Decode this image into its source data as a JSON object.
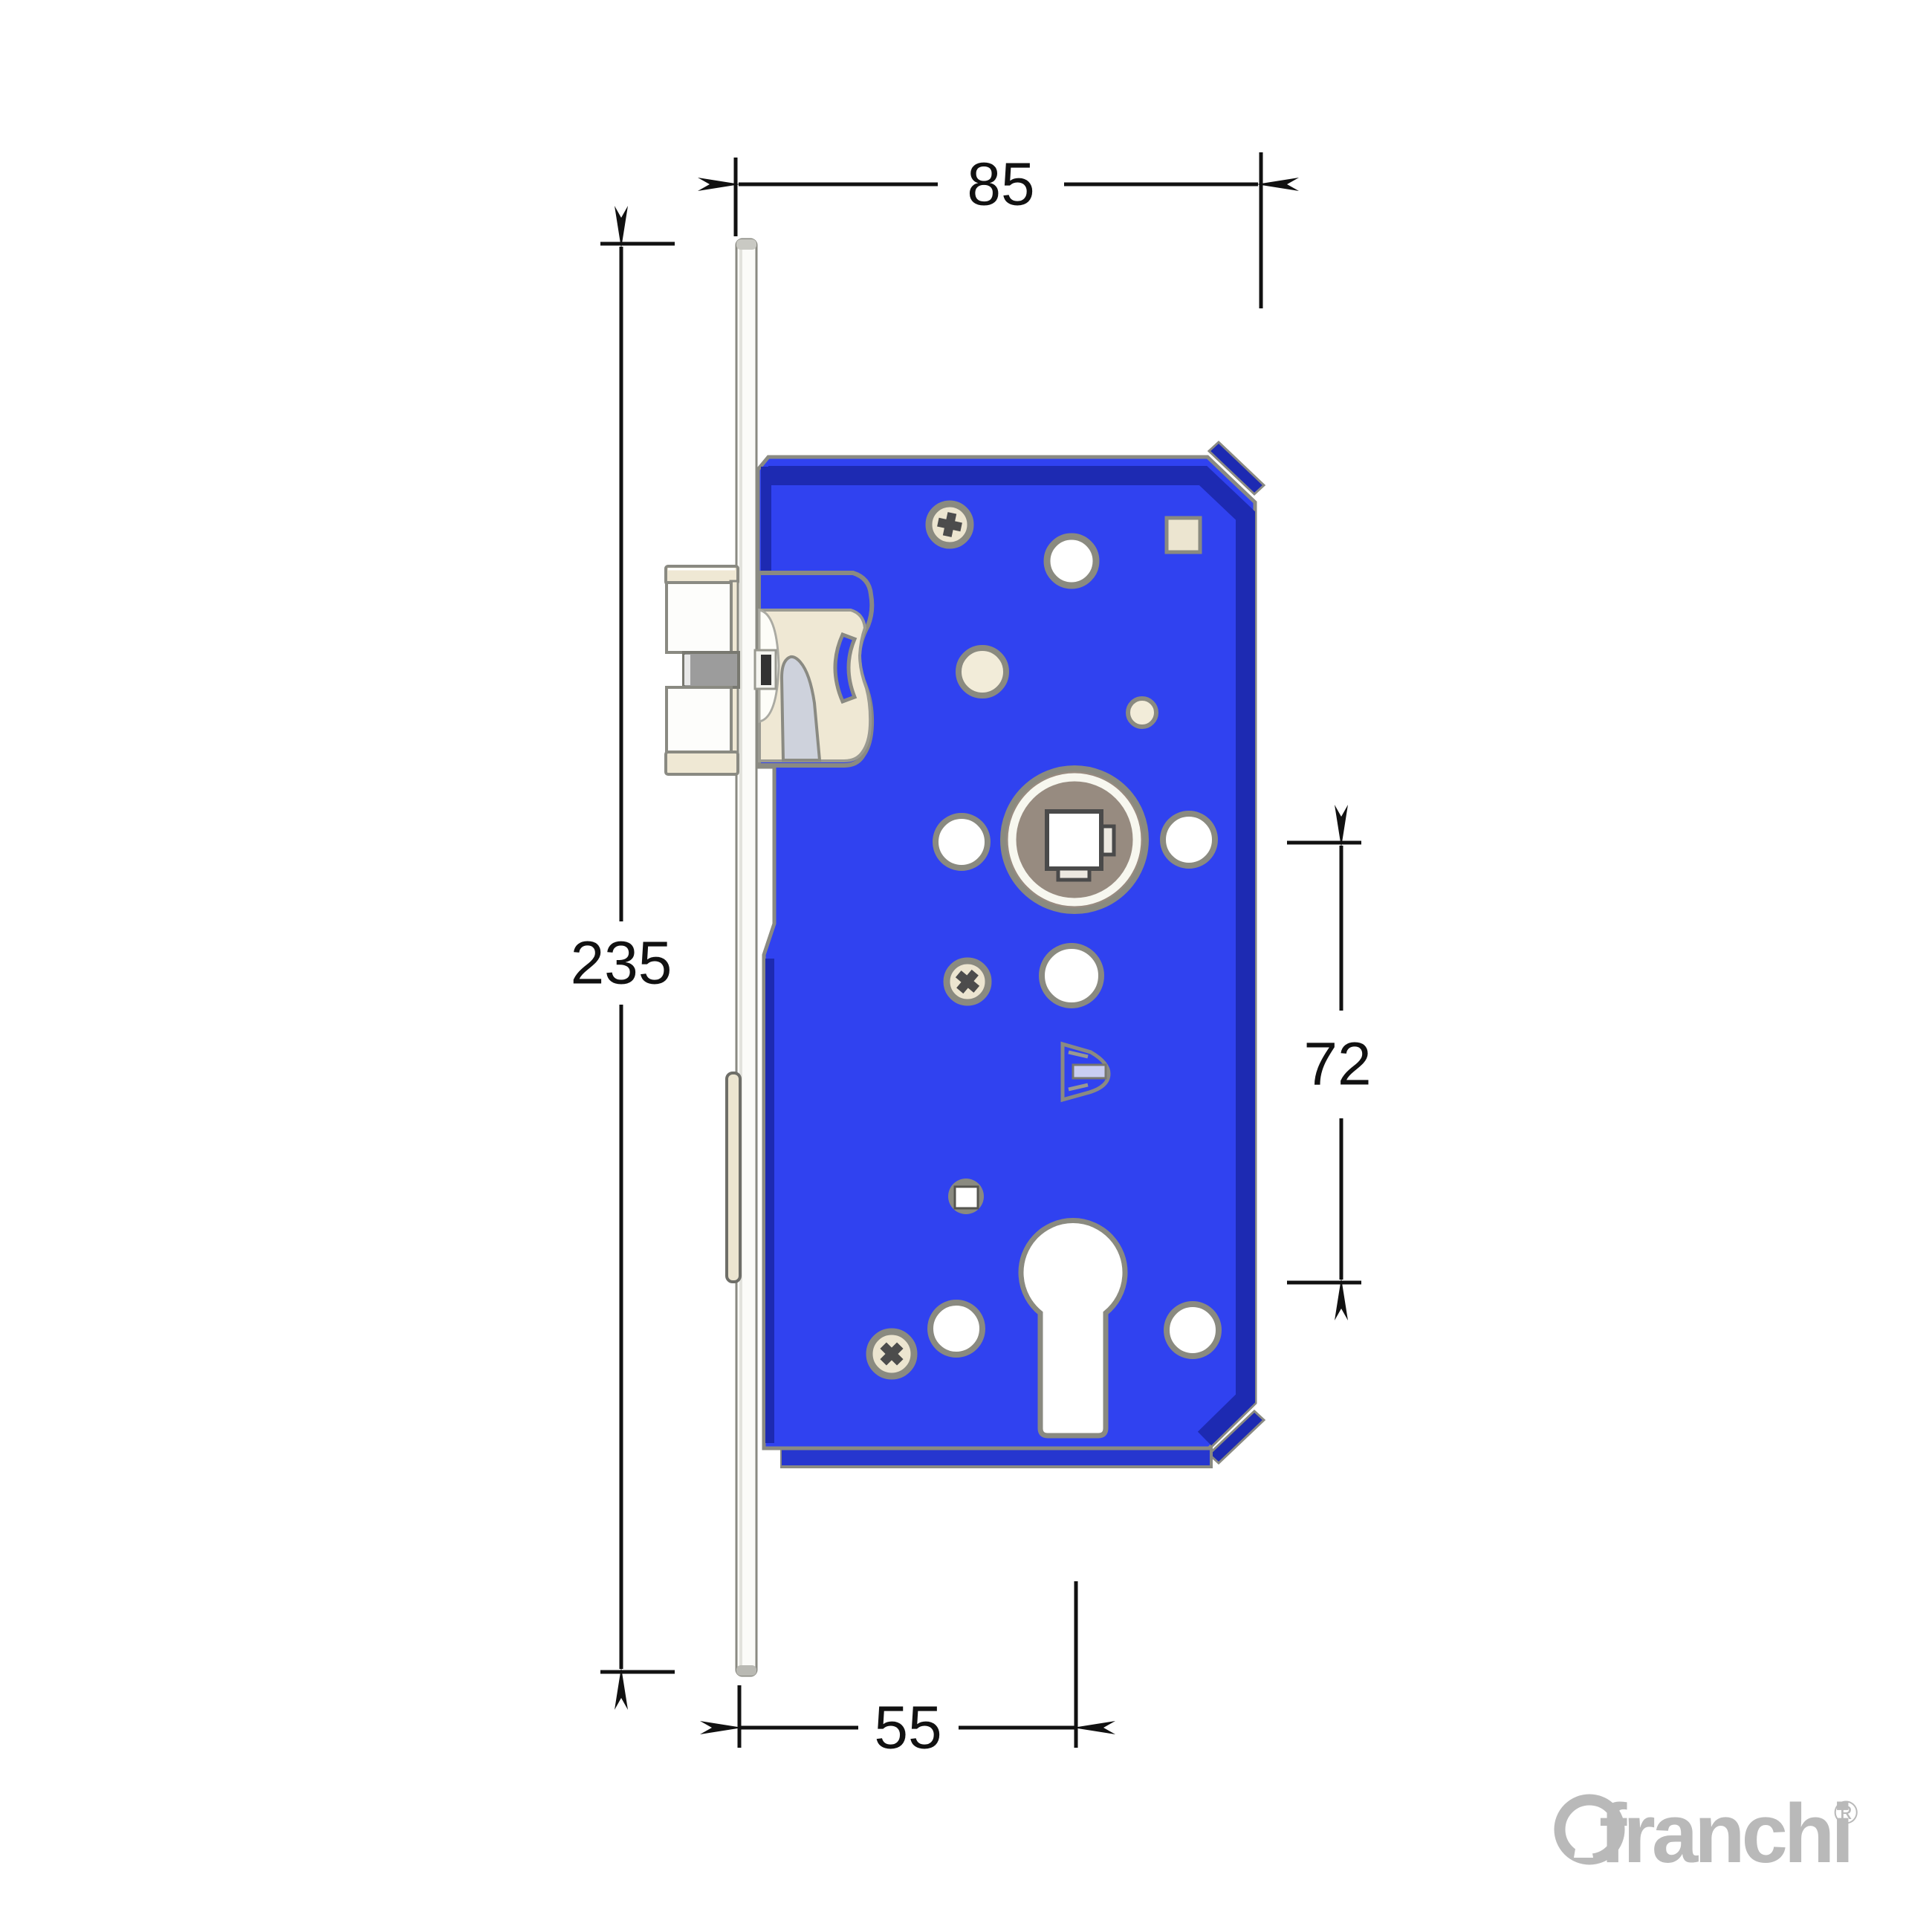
{
  "dimensions": {
    "width": {
      "value": "85"
    },
    "height": {
      "value": "235"
    },
    "centres": {
      "value": "72"
    },
    "backset": {
      "value": "55"
    }
  },
  "logo": {
    "brand": "franchi",
    "registered": "®"
  },
  "colors": {
    "body_blue": "#3042f0",
    "body_dark_blue": "#1d2ab2",
    "flange_blue": "#2636cf",
    "cream": "#efe8d4",
    "cream_light": "#f2ecd9",
    "beige_hole": "#ece5d0",
    "hub_disc": "#978b80",
    "wedge_gray": "#ced2dc",
    "outline_gray": "#8a8a82",
    "notch_gray": "#9c9c9c",
    "dim_black": "#111111",
    "logo_gray": "#b9b9b9",
    "white": "#ffffff"
  }
}
